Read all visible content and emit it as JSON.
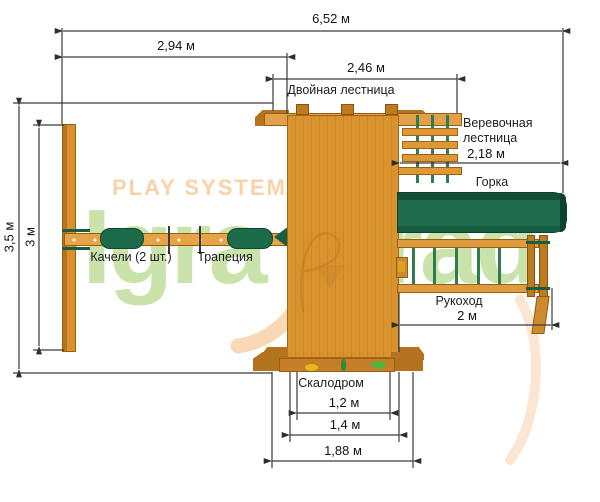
{
  "watermark": {
    "tagline": "PLAY SYSTEM",
    "brand_left": "Igra",
    "brand_right": "Grad"
  },
  "dimensions": {
    "total_width": "6,52 м",
    "swing_section_width": "2,94 м",
    "tower_section_width": "2,46 м",
    "rope_ladder_width": "2,18 м",
    "monkey_bars_length": "2 м",
    "overall_depth": "3,5 м",
    "swing_frame_depth": "3 м",
    "climbing_wall_inner": "1,2 м",
    "climbing_wall_middle": "1,4 м",
    "climbing_wall_outer": "1,88 м"
  },
  "labels": {
    "double_ladder": "Двойная лестница",
    "rope_ladder_line1": "Веревочная",
    "rope_ladder_line2": "лестница",
    "slide": "Горка",
    "swings": "Качели (2 шт.)",
    "trapeze": "Трапеция",
    "monkey_bars": "Рукоход",
    "climbing_wall": "Скалодром"
  },
  "colors": {
    "wood_light": "#DE9A3E",
    "wood_mid": "#D8932F",
    "wood_dark": "#B4731E",
    "slide_green": "#1E6B4E",
    "rope_green": "#2E7D4E",
    "dimension_line": "#3A3A3A",
    "watermark_green": "#9ACA5C",
    "watermark_peach": "#F8D2A8",
    "hold_yellow": "#E3B91E",
    "hold_green": "#55B53A"
  }
}
